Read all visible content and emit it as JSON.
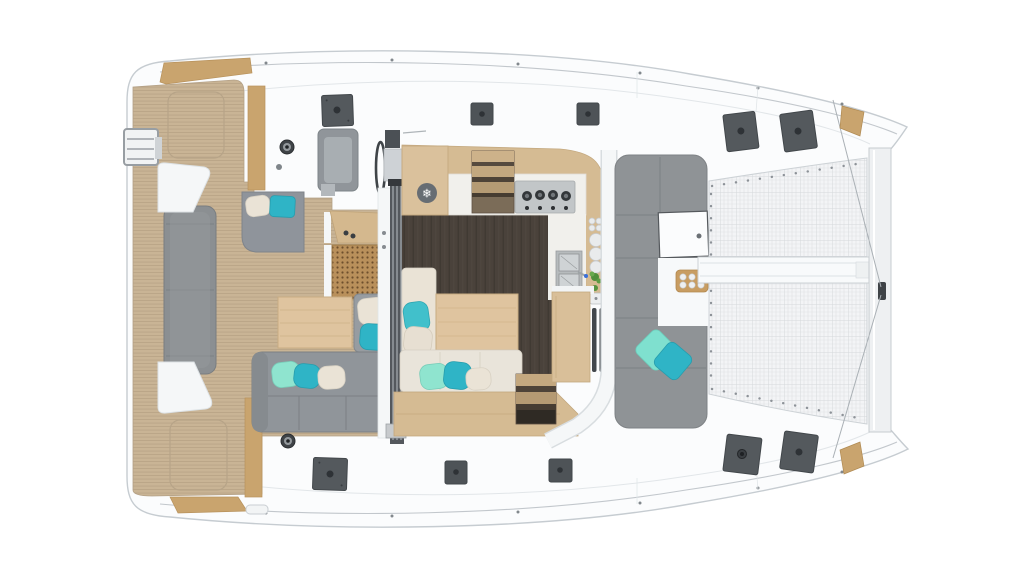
{
  "scene": {
    "type": "catamaran-deck-plan-render",
    "view": "top-down",
    "background": "#ffffff"
  },
  "palette": {
    "hull": "#fbfcfd",
    "hullStroke": "#c6ccd1",
    "seam": "#e2e6e9",
    "rub": "#c2c7cc",
    "teak": "#c9b495",
    "teakLine": "#b5a083",
    "woodLight": "#dfc49f",
    "woodMid": "#d5bb93",
    "woodStrip": "#c9a46e",
    "floor": "#4a423b",
    "floorLine": "#3e3731",
    "gray1": "#8b8f92",
    "gray2": "#90959a",
    "lounge": "#8f9396",
    "seamGray": "#7b8084",
    "cream": "#eae3d6",
    "mint": "#8fe4cf",
    "teal": "#2fb4c6",
    "hatch": "#54595d",
    "hatchDark": "#2e3236",
    "steel": "#c2c6c8",
    "net": "#f3f4f6",
    "netLine": "#dfe2e4",
    "counter": "#f1f0ec",
    "cane": "#b9905b",
    "caneDot": "#6e4f2c",
    "white": "#f5f7f8",
    "green": "#4f8f3b",
    "blue": "#3a6fd8",
    "dark": "#3f4347"
  },
  "saloon": {
    "freezer_icon_glyph": "❄"
  },
  "inventory": {
    "deck_hatches_large": 6,
    "deck_hatches_small": 4,
    "winches": 2,
    "stove_burners": 4,
    "stove_knobs": 4,
    "sink_bowls": 2,
    "helm_wheels": 1,
    "trampoline_panels": 2,
    "cockpit_tables": 2,
    "scatter_cushions": 12,
    "galley_plates": 7,
    "tray_cups": 6
  }
}
